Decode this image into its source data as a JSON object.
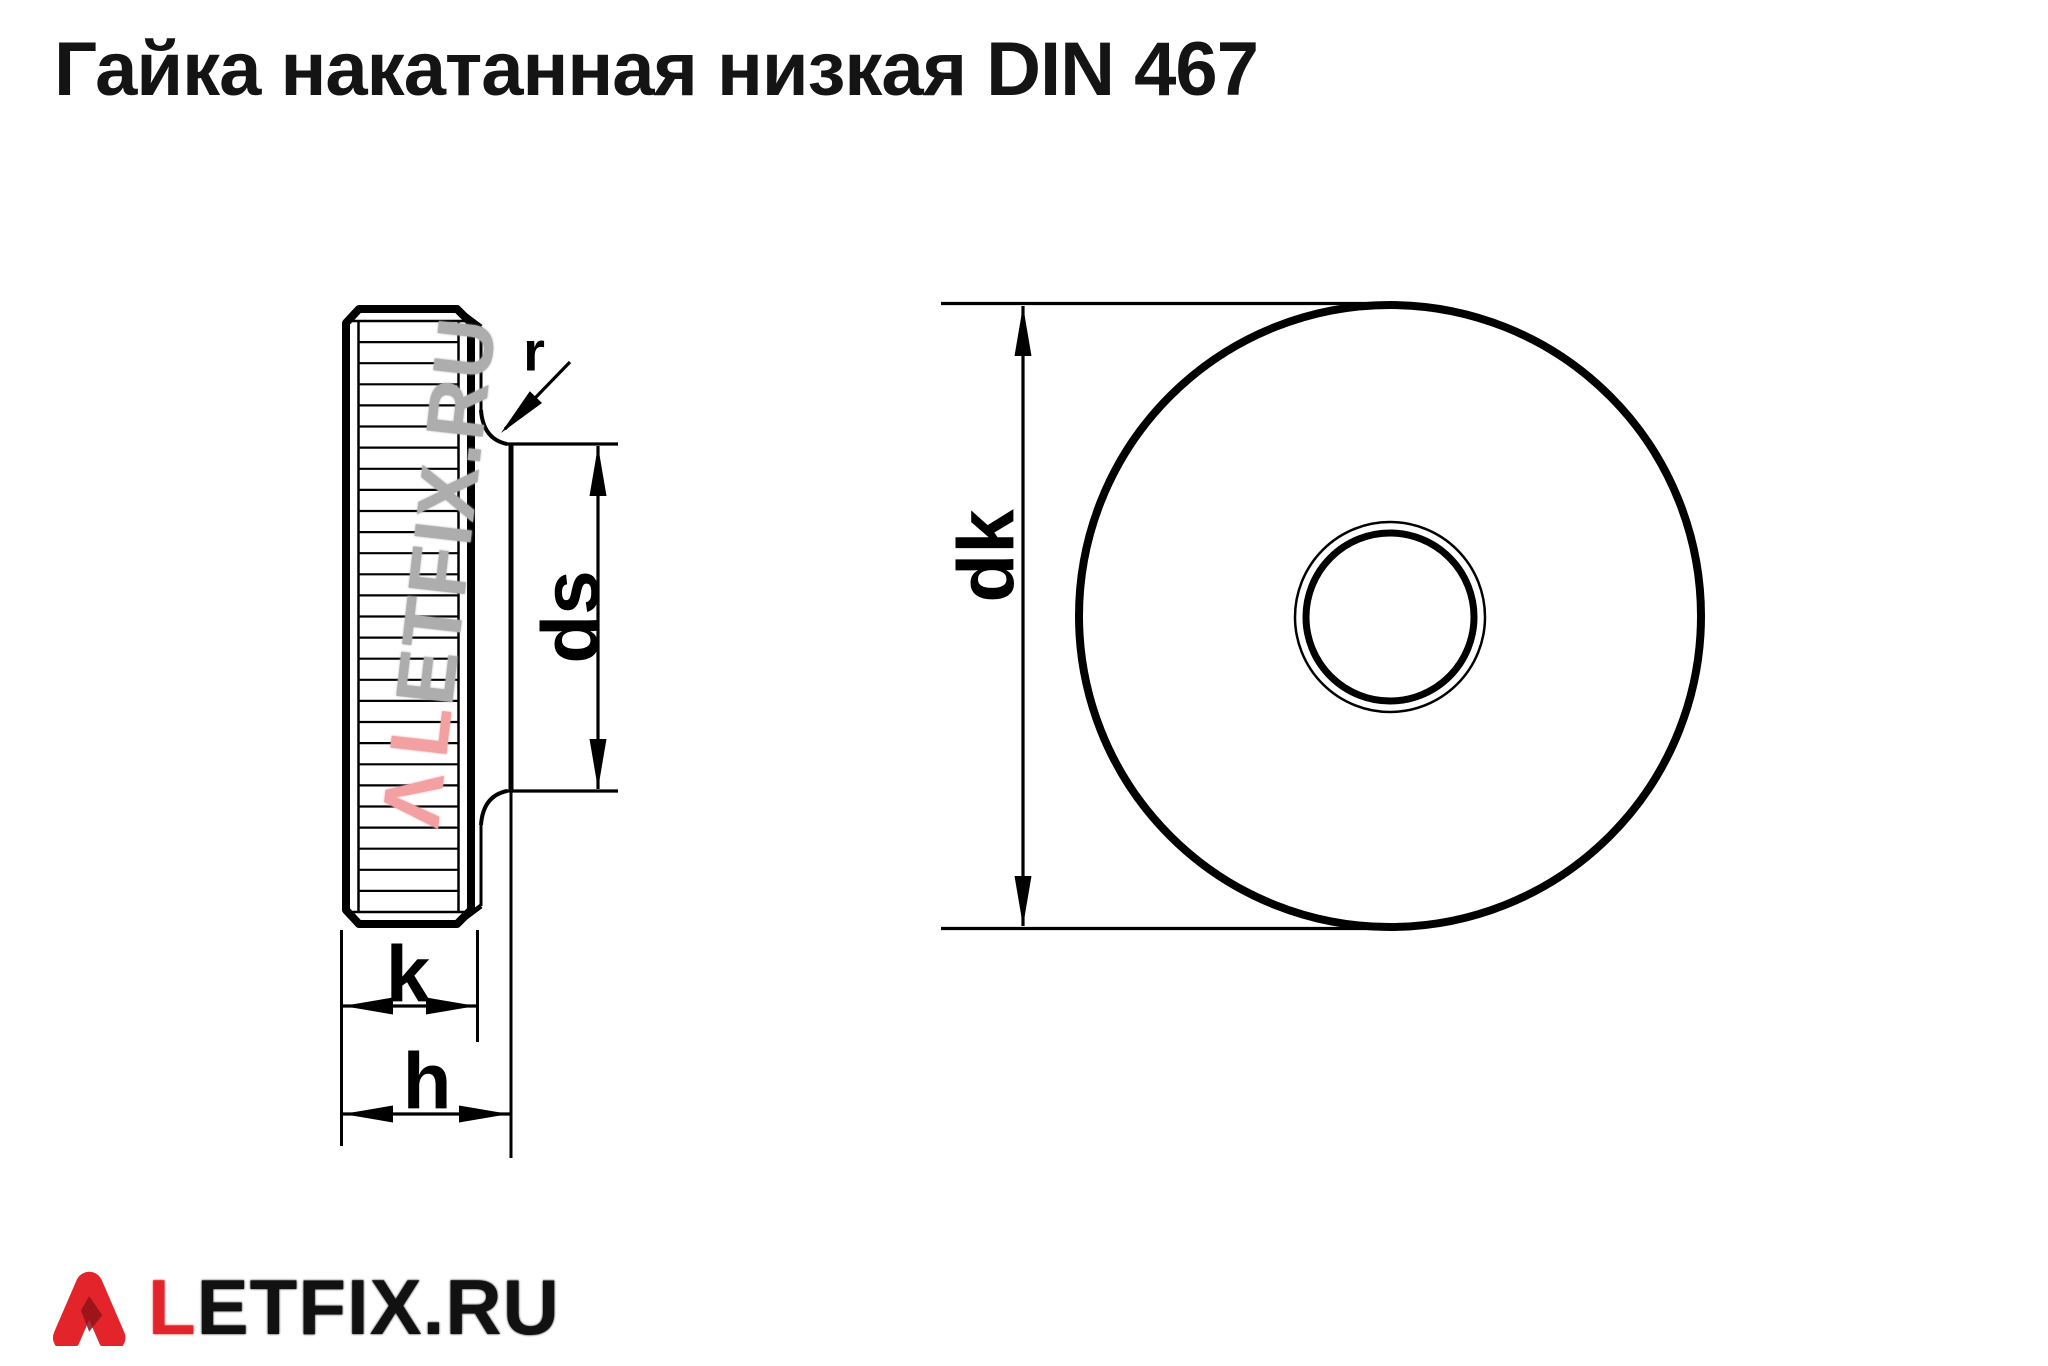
{
  "page": {
    "title": "Гайка накатанная низкая DIN 467"
  },
  "drawing": {
    "type": "technical-drawing",
    "standard": "DIN 467",
    "line_color": "#000000",
    "side_view": {
      "labels": {
        "fillet_radius": "r",
        "boss_diameter": "ds",
        "knurl_thickness": "k",
        "total_height": "h"
      }
    },
    "front_view": {
      "labels": {
        "outer_diameter": "dk"
      }
    }
  },
  "watermark": {
    "mark": "Λ",
    "red_letter": "L",
    "gray_letters": "ETFIX.RU",
    "red_color": "#f2a0a2",
    "gray_color": "#adadad"
  },
  "logo": {
    "red_letter": "L",
    "black_letters": "ETFIX.RU",
    "red_color": "#e3242b",
    "shade_color": "#8f1317",
    "text_color": "#111111"
  }
}
